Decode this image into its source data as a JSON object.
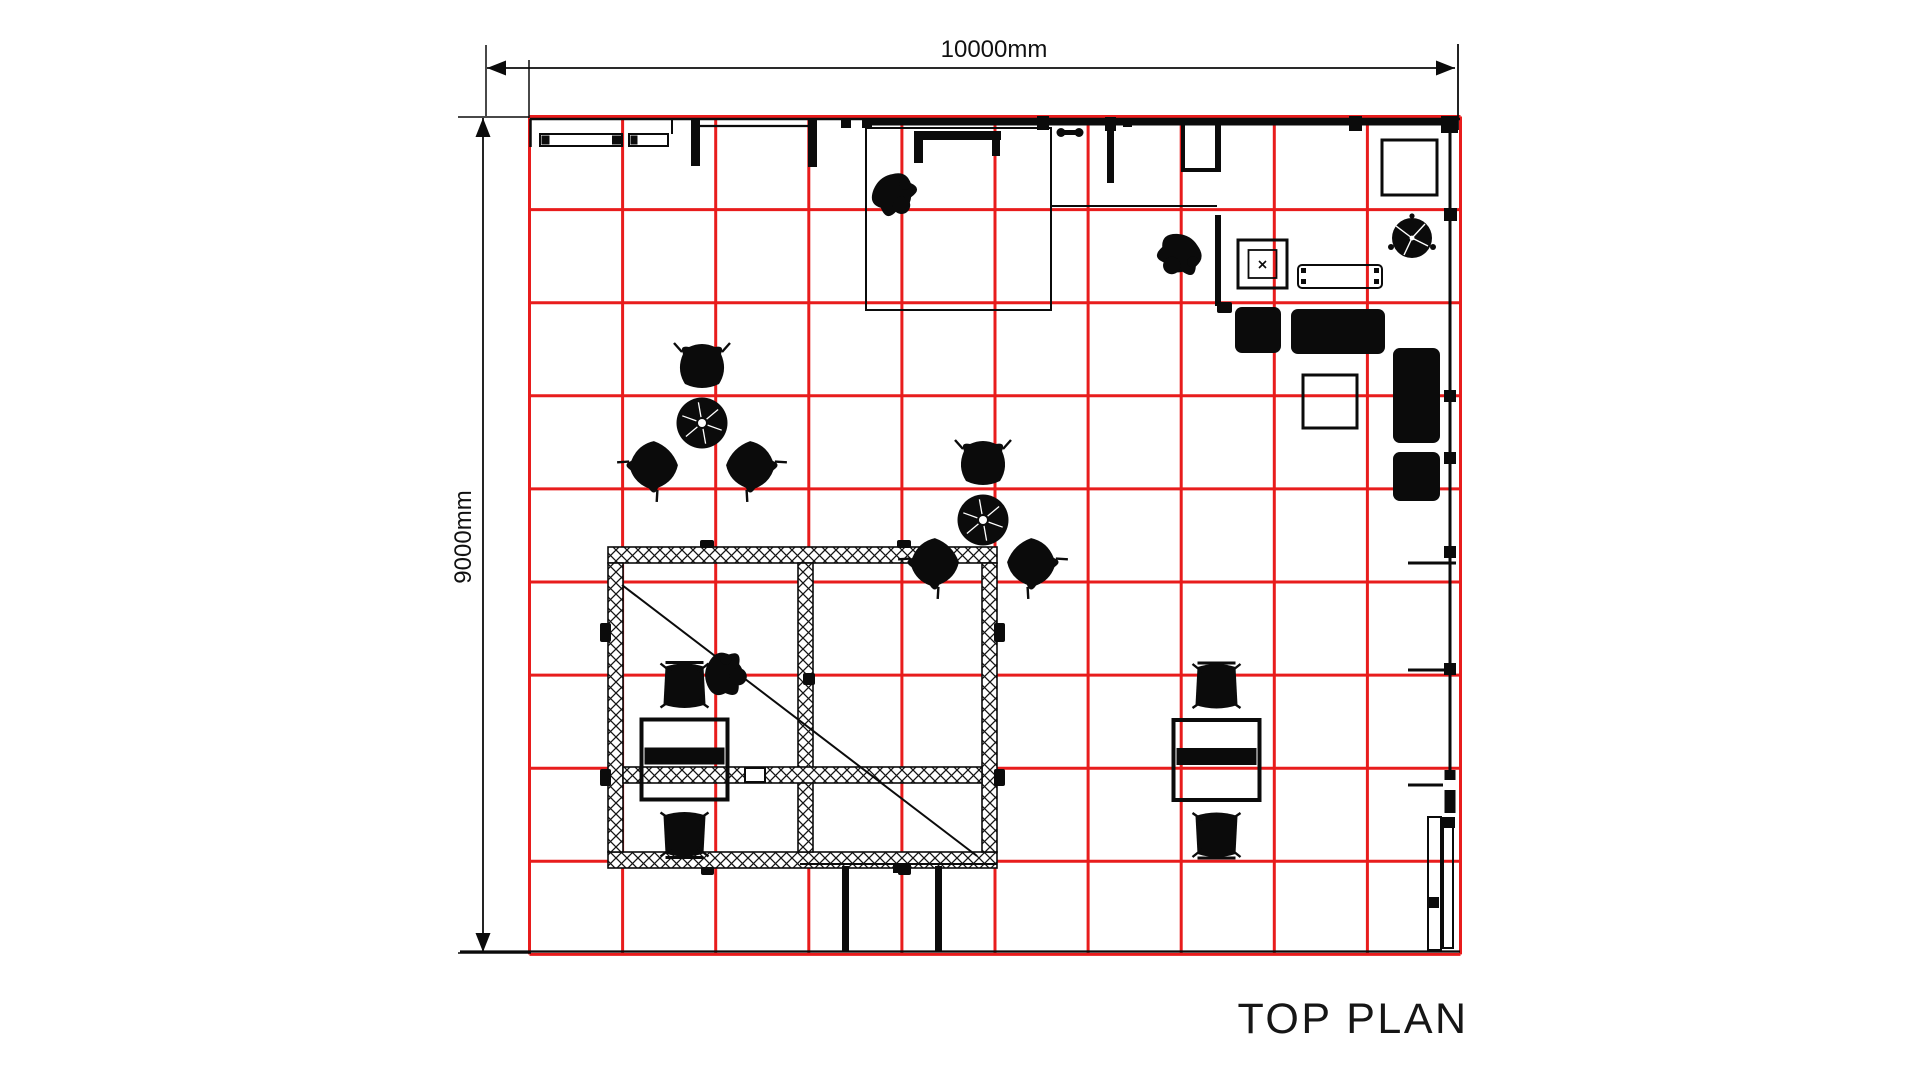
{
  "labels": {
    "top_dim": "10000mm",
    "left_dim": "9000mm",
    "title": "TOP PLAN"
  },
  "drawing": {
    "colors": {
      "red": "#e81c1c",
      "black": "#0b0b0b",
      "white": "#ffffff"
    },
    "grid": {
      "x": 529.5,
      "y": 116.5,
      "cols": 10,
      "rows": 9,
      "cw": 93.1,
      "ch": 93.1,
      "stroke": "red",
      "w": 3
    },
    "shapes": [
      {
        "t": "line",
        "x1": 487,
        "y1": 68,
        "x2": 1455,
        "y2": 68,
        "w": 1.8,
        "n": "top-dimension-line"
      },
      {
        "t": "path",
        "d": "M487,68 L506,60.5 L506,75.5 Z",
        "f": "black",
        "n": "dim-arrow-left"
      },
      {
        "t": "path",
        "d": "M1455,68 L1436,60.5 L1436,75.5 Z",
        "f": "black",
        "n": "dim-arrow-right"
      },
      {
        "t": "line",
        "x1": 486,
        "y1": 45,
        "x2": 486,
        "y2": 116,
        "w": 1.5,
        "n": "extension-line"
      },
      {
        "t": "line",
        "x1": 1458,
        "y1": 44,
        "x2": 1458,
        "y2": 130,
        "w": 1.8,
        "n": "extension-line"
      },
      {
        "t": "line",
        "x1": 529,
        "y1": 60,
        "x2": 529,
        "y2": 118,
        "w": 1.5,
        "n": "extension-line"
      },
      {
        "t": "line",
        "x1": 483,
        "y1": 118,
        "x2": 483,
        "y2": 952,
        "w": 1.8,
        "n": "left-dimension-line"
      },
      {
        "t": "path",
        "d": "M483,118 L475.5,137 L490.5,137 Z",
        "f": "black",
        "n": "dim-arrow-up"
      },
      {
        "t": "path",
        "d": "M483,952 L475.5,933 L490.5,933 Z",
        "f": "black",
        "n": "dim-arrow-down"
      },
      {
        "t": "line",
        "x1": 458,
        "y1": 117,
        "x2": 529,
        "y2": 117,
        "w": 1.5,
        "n": "extension-line"
      },
      {
        "t": "line",
        "x1": 458,
        "y1": 953,
        "x2": 531,
        "y2": 953,
        "w": 1.5,
        "n": "extension-line"
      },
      {
        "t": "line",
        "x1": 460,
        "y1": 951.5,
        "x2": 1460,
        "y2": 951.5,
        "w": 2.2,
        "n": "bottom-wall-line"
      },
      {
        "t": "line",
        "x1": 530,
        "y1": 119,
        "x2": 1460,
        "y2": 119,
        "w": 2.4,
        "n": "top-wall-line"
      },
      {
        "t": "line",
        "x1": 530.5,
        "y1": 119,
        "x2": 530.5,
        "y2": 147,
        "w": 2.5,
        "n": "wall-return"
      },
      {
        "t": "rect",
        "x": 540,
        "y": 134,
        "w": 82,
        "h": 12,
        "sw": 2,
        "f": "none",
        "n": "counter"
      },
      {
        "t": "rect",
        "x": 541.5,
        "y": 135.5,
        "w": 8,
        "h": 9,
        "f": "black",
        "n": "counter-end"
      },
      {
        "t": "rect",
        "x": 612,
        "y": 135.5,
        "w": 9,
        "h": 9,
        "f": "black",
        "n": "counter-end"
      },
      {
        "t": "rect",
        "x": 629,
        "y": 134,
        "w": 39,
        "h": 12,
        "sw": 2,
        "f": "none",
        "n": "counter"
      },
      {
        "t": "rect",
        "x": 630.5,
        "y": 135.5,
        "w": 7,
        "h": 9,
        "f": "black",
        "n": "counter-end"
      },
      {
        "t": "line",
        "x1": 672,
        "y1": 119,
        "x2": 672,
        "y2": 134,
        "w": 2,
        "n": "wall-step"
      },
      {
        "t": "rect",
        "x": 691,
        "y": 119,
        "w": 9,
        "h": 47,
        "f": "black",
        "n": "wall-post"
      },
      {
        "t": "line",
        "x1": 700,
        "y1": 126,
        "x2": 812,
        "y2": 126,
        "w": 2.2,
        "n": "wall-line"
      },
      {
        "t": "rect",
        "x": 808,
        "y": 119,
        "w": 9,
        "h": 48,
        "f": "black",
        "n": "wall-post"
      },
      {
        "t": "rect",
        "x": 841,
        "y": 118,
        "w": 10,
        "h": 10,
        "f": "black",
        "n": "wall-block"
      },
      {
        "t": "rect",
        "x": 862,
        "y": 118,
        "w": 10,
        "h": 10,
        "f": "black",
        "n": "wall-block"
      },
      {
        "t": "line",
        "x1": 865,
        "y1": 122.5,
        "x2": 1052,
        "y2": 122.5,
        "w": 6,
        "n": "wall-heavy"
      },
      {
        "t": "rect",
        "x": 1037,
        "y": 116,
        "w": 12,
        "h": 14,
        "f": "black",
        "n": "wall-block"
      },
      {
        "t": "line",
        "x1": 1050,
        "y1": 122.5,
        "x2": 1213,
        "y2": 122.5,
        "w": 6,
        "n": "wall-heavy"
      },
      {
        "t": "rect",
        "x": 1105,
        "y": 117,
        "w": 11,
        "h": 14,
        "f": "black",
        "n": "wall-block"
      },
      {
        "t": "rect",
        "x": 1123,
        "y": 119,
        "w": 9,
        "h": 8,
        "f": "black",
        "n": "wall-block"
      },
      {
        "t": "rect",
        "x": 1060,
        "y": 130,
        "w": 20,
        "h": 5,
        "f": "black",
        "n": "door-pivot"
      },
      {
        "t": "circle",
        "cx": 1061,
        "cy": 132.5,
        "r": 4.5,
        "f": "black",
        "n": "door-pivot-cap"
      },
      {
        "t": "circle",
        "cx": 1079,
        "cy": 132.5,
        "r": 4.5,
        "f": "black",
        "n": "door-pivot-cap"
      },
      {
        "t": "rect",
        "x": 1107,
        "y": 122,
        "w": 7,
        "h": 61,
        "f": "black",
        "n": "wall-post"
      },
      {
        "t": "line",
        "x1": 1181,
        "y1": 122.5,
        "x2": 1456,
        "y2": 122.5,
        "w": 6,
        "n": "wall-heavy"
      },
      {
        "t": "rect",
        "x": 1349,
        "y": 116,
        "w": 13,
        "h": 15,
        "f": "black",
        "n": "wall-block"
      },
      {
        "t": "rect",
        "x": 1441,
        "y": 116,
        "w": 17,
        "h": 17,
        "f": "black",
        "n": "corner-block"
      },
      {
        "t": "rect",
        "x": 866,
        "y": 128,
        "w": 185,
        "h": 182,
        "sw": 2,
        "f": "none",
        "n": "room-outline"
      },
      {
        "t": "rect",
        "x": 914,
        "y": 131,
        "w": 87,
        "h": 9,
        "f": "black",
        "n": "bracket"
      },
      {
        "t": "rect",
        "x": 914,
        "y": 131,
        "w": 9,
        "h": 32,
        "f": "black",
        "n": "bracket-leg"
      },
      {
        "t": "rect",
        "x": 992,
        "y": 131,
        "w": 8,
        "h": 25,
        "f": "black",
        "n": "bracket-leg"
      },
      {
        "t": "line",
        "x1": 1051,
        "y1": 206,
        "x2": 1217,
        "y2": 206,
        "w": 2,
        "n": "partition-line"
      },
      {
        "t": "line",
        "x1": 1218,
        "y1": 122,
        "x2": 1218,
        "y2": 172,
        "w": 6,
        "n": "room-wall"
      },
      {
        "t": "line",
        "x1": 1218,
        "y1": 215,
        "x2": 1218,
        "y2": 306,
        "w": 6,
        "n": "room-wall"
      },
      {
        "t": "line",
        "x1": 1183,
        "y1": 123,
        "x2": 1183,
        "y2": 172,
        "w": 4,
        "n": "wall-stub"
      },
      {
        "t": "line",
        "x1": 1183,
        "y1": 170,
        "x2": 1216,
        "y2": 170,
        "w": 4,
        "n": "wall-stub"
      },
      {
        "t": "rect",
        "x": 1382,
        "y": 140,
        "w": 55,
        "h": 55,
        "sw": 3,
        "f": "none",
        "n": "square-table"
      },
      {
        "t": "circle",
        "cx": 1412,
        "cy": 238,
        "r": 20,
        "f": "black",
        "n": "plant"
      },
      {
        "t": "line",
        "x1": 1412,
        "y1": 238,
        "x2": 1425,
        "y2": 224,
        "w": 1.4,
        "c": "white",
        "n": "plant-leaf"
      },
      {
        "t": "line",
        "x1": 1412,
        "y1": 238,
        "x2": 1396,
        "y2": 226,
        "w": 1.4,
        "c": "white",
        "n": "plant-leaf"
      },
      {
        "t": "line",
        "x1": 1412,
        "y1": 238,
        "x2": 1428,
        "y2": 246,
        "w": 1.4,
        "c": "white",
        "n": "plant-leaf"
      },
      {
        "t": "line",
        "x1": 1412,
        "y1": 238,
        "x2": 1404,
        "y2": 255,
        "w": 1.4,
        "c": "white",
        "n": "plant-leaf"
      },
      {
        "t": "circle",
        "cx": 1412,
        "cy": 238,
        "r": 2.4,
        "f": "white",
        "n": "plant-center"
      },
      {
        "t": "circle",
        "cx": 1391,
        "cy": 247,
        "r": 3,
        "f": "black",
        "n": "plant-nub"
      },
      {
        "t": "circle",
        "cx": 1433,
        "cy": 247,
        "r": 3,
        "f": "black",
        "n": "plant-nub"
      },
      {
        "t": "circle",
        "cx": 1412,
        "cy": 216,
        "r": 2.6,
        "f": "black",
        "n": "plant-nub"
      },
      {
        "t": "rect",
        "x": 1238,
        "y": 240,
        "w": 49,
        "h": 48,
        "sw": 3,
        "f": "none",
        "n": "pedestal"
      },
      {
        "t": "rect",
        "x": 1248.5,
        "y": 250,
        "w": 28,
        "h": 28,
        "sw": 1.8,
        "f": "none",
        "n": "pedestal-inner"
      },
      {
        "t": "path",
        "d": "M1259,261 L1266,268 M1266,261 L1259,268",
        "sw": 1.6,
        "f": "none",
        "n": "pedestal-mark"
      },
      {
        "t": "rect",
        "x": 1298,
        "y": 265,
        "w": 84,
        "h": 23,
        "sw": 2,
        "rx": 4,
        "f": "none",
        "n": "bench"
      },
      {
        "t": "rect",
        "x": 1301,
        "y": 268,
        "w": 5,
        "h": 5,
        "f": "black",
        "n": "bench-leg"
      },
      {
        "t": "rect",
        "x": 1374,
        "y": 268,
        "w": 5,
        "h": 5,
        "f": "black",
        "n": "bench-leg"
      },
      {
        "t": "rect",
        "x": 1301,
        "y": 279,
        "w": 5,
        "h": 5,
        "f": "black",
        "n": "bench-leg"
      },
      {
        "t": "rect",
        "x": 1374,
        "y": 279,
        "w": 5,
        "h": 5,
        "f": "black",
        "n": "bench-leg"
      },
      {
        "t": "line",
        "x1": 1450,
        "y1": 131,
        "x2": 1450,
        "y2": 306,
        "w": 3,
        "n": "right-wall"
      },
      {
        "t": "rect",
        "x": 1444,
        "y": 208,
        "w": 13,
        "h": 13,
        "f": "black",
        "n": "wall-block"
      },
      {
        "t": "rect",
        "x": 1217,
        "y": 302,
        "w": 15,
        "h": 11,
        "rx": 2,
        "f": "black",
        "n": "sofa-arm"
      },
      {
        "t": "rect",
        "x": 1235,
        "y": 307,
        "w": 46,
        "h": 46,
        "rx": 7,
        "f": "black",
        "n": "sofa"
      },
      {
        "t": "rect",
        "x": 1291,
        "y": 309,
        "w": 94,
        "h": 45,
        "rx": 7,
        "f": "black",
        "n": "sofa"
      },
      {
        "t": "rect",
        "x": 1393,
        "y": 348,
        "w": 47,
        "h": 95,
        "rx": 7,
        "f": "black",
        "n": "sofa"
      },
      {
        "t": "rect",
        "x": 1393,
        "y": 452,
        "w": 47,
        "h": 49,
        "rx": 7,
        "f": "black",
        "n": "sofa"
      },
      {
        "t": "rect",
        "x": 1303,
        "y": 375,
        "w": 54,
        "h": 53,
        "sw": 3,
        "f": "none",
        "n": "coffee-table"
      },
      {
        "t": "line",
        "x1": 1450,
        "y1": 306,
        "x2": 1450,
        "y2": 563,
        "w": 3,
        "n": "right-wall"
      },
      {
        "t": "rect",
        "x": 1444,
        "y": 390,
        "w": 12,
        "h": 12,
        "f": "black",
        "n": "wall-block"
      },
      {
        "t": "rect",
        "x": 1444,
        "y": 452,
        "w": 12,
        "h": 12,
        "f": "black",
        "n": "wall-block"
      },
      {
        "t": "rect",
        "x": 1444,
        "y": 546,
        "w": 12,
        "h": 12,
        "f": "black",
        "n": "wall-block"
      },
      {
        "t": "line",
        "x1": 1408,
        "y1": 563,
        "x2": 1456,
        "y2": 563,
        "w": 3,
        "n": "wall-stub"
      },
      {
        "t": "line",
        "x1": 1450,
        "y1": 563,
        "x2": 1450,
        "y2": 770,
        "w": 3,
        "n": "right-wall"
      },
      {
        "t": "line",
        "x1": 1408,
        "y1": 670,
        "x2": 1450,
        "y2": 670,
        "w": 3,
        "n": "wall-stub"
      },
      {
        "t": "rect",
        "x": 1444,
        "y": 663,
        "w": 12,
        "h": 12,
        "f": "black",
        "n": "wall-block"
      },
      {
        "t": "rect",
        "x": 1444.5,
        "y": 770,
        "w": 11,
        "h": 10,
        "f": "black",
        "n": "wall-block"
      },
      {
        "t": "rect",
        "x": 1444.5,
        "y": 790,
        "w": 11,
        "h": 23,
        "f": "black",
        "n": "wall-block"
      },
      {
        "t": "line",
        "x1": 1408,
        "y1": 785,
        "x2": 1443,
        "y2": 785,
        "w": 3,
        "n": "wall-stub"
      },
      {
        "t": "rect",
        "x": 1428,
        "y": 817,
        "w": 13,
        "h": 133,
        "sw": 2,
        "f": "none",
        "n": "door-leaf"
      },
      {
        "t": "rect",
        "x": 1443,
        "y": 820,
        "w": 10,
        "h": 128,
        "sw": 2,
        "f": "none",
        "n": "door-leaf"
      },
      {
        "t": "rect",
        "x": 1427,
        "y": 897,
        "w": 12,
        "h": 11,
        "f": "black",
        "n": "door-block"
      },
      {
        "t": "rect",
        "x": 1442,
        "y": 817,
        "w": 13,
        "h": 11,
        "f": "black",
        "n": "door-block"
      },
      {
        "t": "rect",
        "x": 608,
        "y": 547,
        "w": 389,
        "h": 16,
        "f": "hatch",
        "sw": 1.6,
        "n": "truss-beam"
      },
      {
        "t": "rect",
        "x": 608,
        "y": 852,
        "w": 389,
        "h": 16,
        "f": "hatch",
        "sw": 1.6,
        "n": "truss-beam"
      },
      {
        "t": "rect",
        "x": 608,
        "y": 563,
        "w": 15,
        "h": 289,
        "f": "hatch",
        "sw": 1.6,
        "n": "truss-beam"
      },
      {
        "t": "rect",
        "x": 982,
        "y": 563,
        "w": 15,
        "h": 289,
        "f": "hatch",
        "sw": 1.6,
        "n": "truss-beam"
      },
      {
        "t": "rect",
        "x": 798,
        "y": 563,
        "w": 15,
        "h": 289,
        "f": "hatch",
        "sw": 1.6,
        "n": "truss-beam"
      },
      {
        "t": "rect",
        "x": 623,
        "y": 767,
        "w": 359,
        "h": 16,
        "f": "hatch",
        "sw": 1.6,
        "n": "truss-beam"
      },
      {
        "t": "line",
        "x1": 622,
        "y1": 585,
        "x2": 977,
        "y2": 856,
        "w": 2,
        "n": "diagonal-brace"
      },
      {
        "t": "rect",
        "x": 700,
        "y": 540,
        "w": 14,
        "h": 8,
        "rx": 2,
        "f": "black",
        "n": "truss-tab"
      },
      {
        "t": "rect",
        "x": 897,
        "y": 540,
        "w": 14,
        "h": 8,
        "rx": 2,
        "f": "black",
        "n": "truss-tab"
      },
      {
        "t": "rect",
        "x": 701,
        "y": 867,
        "w": 13,
        "h": 8,
        "rx": 2,
        "f": "black",
        "n": "truss-tab"
      },
      {
        "t": "rect",
        "x": 898,
        "y": 867,
        "w": 13,
        "h": 8,
        "rx": 2,
        "f": "black",
        "n": "truss-tab"
      },
      {
        "t": "rect",
        "x": 600,
        "y": 623,
        "w": 11,
        "h": 19,
        "rx": 2,
        "f": "black",
        "n": "truss-tab"
      },
      {
        "t": "rect",
        "x": 994,
        "y": 623,
        "w": 11,
        "h": 19,
        "rx": 2,
        "f": "black",
        "n": "truss-tab"
      },
      {
        "t": "rect",
        "x": 600,
        "y": 769,
        "w": 11,
        "h": 17,
        "rx": 2,
        "f": "black",
        "n": "truss-tab"
      },
      {
        "t": "rect",
        "x": 994,
        "y": 769,
        "w": 11,
        "h": 17,
        "rx": 2,
        "f": "black",
        "n": "truss-tab"
      },
      {
        "t": "rect",
        "x": 803,
        "y": 673,
        "w": 12,
        "h": 12,
        "rx": 2,
        "f": "black",
        "n": "truss-tab"
      },
      {
        "t": "rect",
        "x": 745,
        "y": 768,
        "w": 20,
        "h": 14,
        "sw": 2,
        "f": "white",
        "n": "truss-plate"
      },
      {
        "t": "line",
        "x1": 800,
        "y1": 864,
        "x2": 997,
        "y2": 864,
        "w": 2,
        "n": "frame-line"
      },
      {
        "t": "rect",
        "x": 842,
        "y": 866,
        "w": 7,
        "h": 85,
        "f": "black",
        "n": "door-post"
      },
      {
        "t": "rect",
        "x": 935,
        "y": 866,
        "w": 7,
        "h": 85,
        "f": "black",
        "n": "door-post"
      },
      {
        "t": "rect",
        "x": 893,
        "y": 864,
        "w": 18,
        "h": 9,
        "f": "black",
        "n": "frame-block"
      },
      {
        "t": "use",
        "id": "sym-deskset",
        "x": 684.5,
        "y": 759.5,
        "n": "desk-set"
      },
      {
        "t": "use",
        "id": "sym-deskset",
        "x": 1216.5,
        "y": 760,
        "n": "desk-set"
      },
      {
        "t": "use",
        "id": "sym-table3",
        "x": 702,
        "y": 423,
        "n": "round-table-set"
      },
      {
        "t": "use",
        "id": "sym-table3",
        "x": 983,
        "y": 520,
        "n": "round-table-set"
      },
      {
        "t": "use",
        "id": "sym-person",
        "x": 892,
        "y": 192,
        "r": 140,
        "sc": 1.25,
        "n": "person"
      },
      {
        "t": "use",
        "id": "sym-person",
        "x": 1181,
        "y": 252,
        "r": 210,
        "sc": 1.25,
        "n": "person"
      },
      {
        "t": "use",
        "id": "sym-person",
        "x": 722,
        "y": 674,
        "r": 95,
        "sc": 1.25,
        "n": "person"
      }
    ]
  }
}
